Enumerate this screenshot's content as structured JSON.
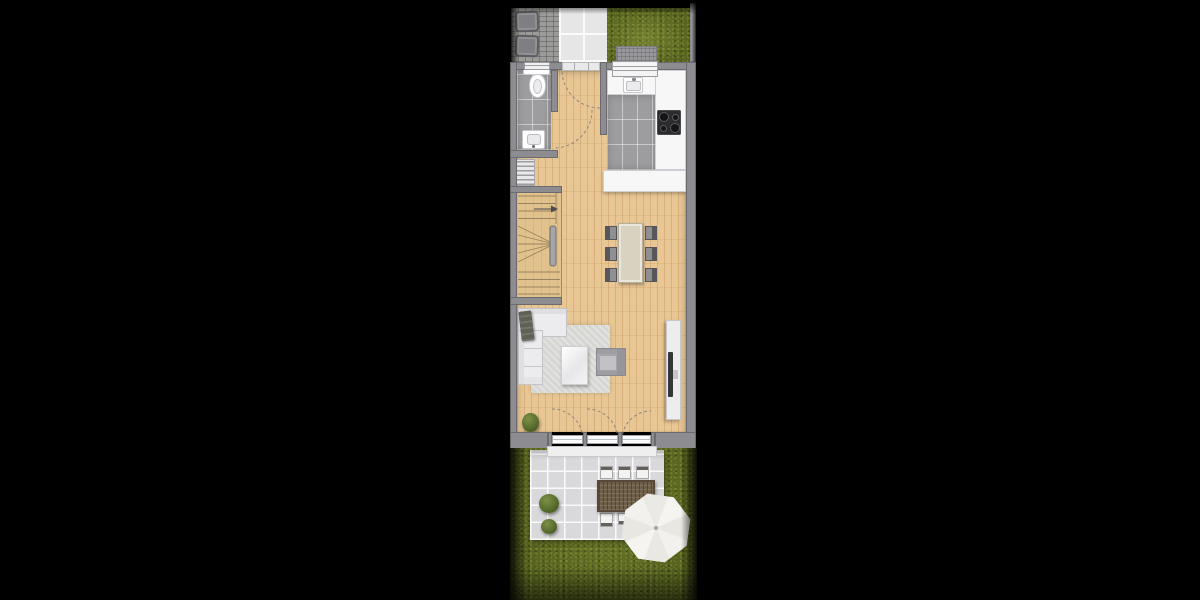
{
  "scene": {
    "kind": "residential floor plan, top-down 3D render on black background",
    "background": "#000000",
    "plan_strip": {
      "left_px": 510,
      "width_px": 190,
      "height_px": 600
    }
  },
  "colors": {
    "wall": "#8d8d91",
    "wallDark": "#6e6e73",
    "wood": "#e9c795",
    "grayTile": "#9d9da0",
    "counter": "#f7f7f8",
    "counterBorder": "#cfcfd3",
    "grass": "#57631f",
    "grassLight": "#76863a",
    "cobble": "#9b9b99",
    "walkway": "#e6e6e6",
    "terrace": "#d9d9db",
    "rug": "#d6d6d3",
    "sofa": "#ececee",
    "blanket": "#5f6156",
    "diningTable": "#d9d2c0",
    "chairDark": "#56565b",
    "chairSeat": "#8f8f94",
    "wicker": "#6e5f48",
    "parasol": "#f2f1ec",
    "cooktop": "#2b2b2e",
    "bush": "#54682a",
    "doorArc": "#8f8579",
    "fence": "#b7b7ba",
    "binGray": "#7f7f83",
    "sideboard": "#ededee",
    "tv": "#37373a",
    "doormat": "#98989c",
    "stairTread": "#97835c",
    "rail": "#a6a6aa"
  },
  "inventory": {
    "outdoor_front": {
      "paved_area": 1,
      "waste_bins": 2,
      "tile_walkway": 1,
      "lawn": 1,
      "doormat": 1,
      "boundary_fence": 1
    },
    "bathroom": {
      "toilet": 1,
      "washbasin": 1,
      "window": 1,
      "door_swing_arc": 1,
      "floor": "gray tile"
    },
    "kitchen": {
      "counter_runs": 3,
      "sink": 1,
      "cooktop_burners": 4,
      "window": 1,
      "floor": "gray tile"
    },
    "hall": {
      "entrance_door_swing_arc": 1,
      "slatted_shelf": 1,
      "floor": "wood"
    },
    "stairs": {
      "type": "winder U-stair",
      "handrail": 1,
      "direction_arrow": 1
    },
    "dining": {
      "table": 1,
      "chairs": 6,
      "floor": "wood"
    },
    "living": {
      "corner_sofa": 1,
      "throw_blanket": 1,
      "rug": 1,
      "coffee_table": 1,
      "armchair": 1,
      "tv_sideboard": 1,
      "tv": 1,
      "plant": 1
    },
    "patio_doors": {
      "glass_panels": 3,
      "swing_arcs": 3,
      "threshold_step": 1
    },
    "terrace": {
      "tiled_patio": 1,
      "outdoor_table": 1,
      "chairs_visible": 5,
      "parasol": 1,
      "bushes": 2
    },
    "garden": {
      "lawn": 1
    }
  }
}
